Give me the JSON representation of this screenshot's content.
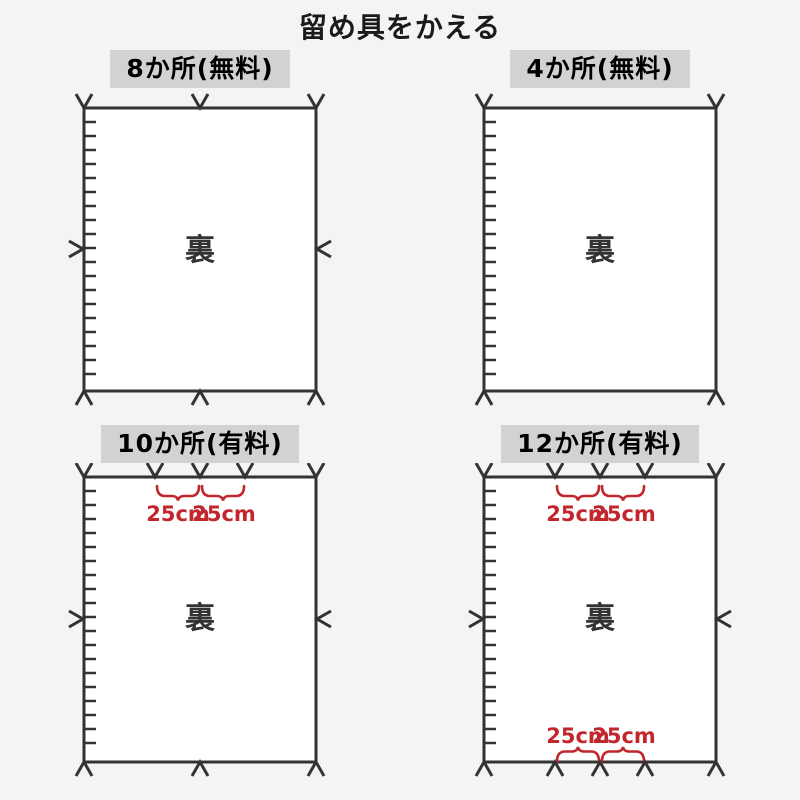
{
  "title": "留め具をかえる",
  "colors": {
    "page_bg": "#f4f4f4",
    "header_bg": "#d2d2d2",
    "line": "#333333",
    "accent_red": "#c1272d",
    "panel_fill": "#ffffff"
  },
  "panels": [
    {
      "header": "8か所(無料)",
      "price_type": "無料",
      "back_label": "裏",
      "fastener_positions": {
        "top": 3,
        "bottom": 3,
        "left": 1,
        "right": 1
      },
      "measurements": {
        "top": [],
        "bottom": []
      }
    },
    {
      "header": "4か所(無料)",
      "price_type": "無料",
      "back_label": "裏",
      "fastener_positions": {
        "top": 2,
        "bottom": 2,
        "left": 0,
        "right": 0
      },
      "measurements": {
        "top": [],
        "bottom": []
      }
    },
    {
      "header": "10か所(有料)",
      "price_type": "有料",
      "back_label": "裏",
      "fastener_positions": {
        "top": 5,
        "bottom": 3,
        "left": 1,
        "right": 1
      },
      "measurements": {
        "top": [
          "25cm",
          "25cm"
        ],
        "bottom": []
      }
    },
    {
      "header": "12か所(有料)",
      "price_type": "有料",
      "back_label": "裏",
      "fastener_positions": {
        "top": 5,
        "bottom": 5,
        "left": 1,
        "right": 1
      },
      "measurements": {
        "top": [
          "25cm",
          "25cm"
        ],
        "bottom": [
          "25cm",
          "25cm"
        ]
      }
    }
  ]
}
